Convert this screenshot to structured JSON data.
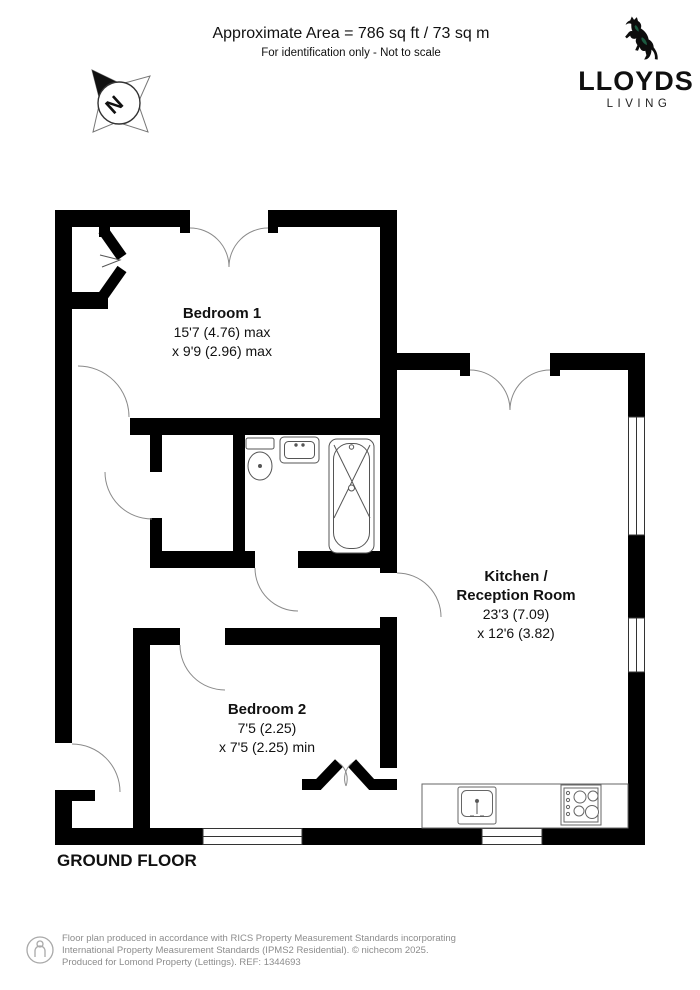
{
  "header": {
    "area": "Approximate Area = 786 sq ft / 73 sq m",
    "note": "For identification only - Not to scale"
  },
  "brand": {
    "name": "LLOYDS",
    "division": "LIVING",
    "horse_black": "#0d0d0d",
    "horse_green": "#1c5b41"
  },
  "compass": {
    "north_label": "N"
  },
  "floor": {
    "label": "GROUND FLOOR"
  },
  "rooms": {
    "bedroom1": {
      "name": "Bedroom 1",
      "dim1": "15'7 (4.76) max",
      "dim2": "x 9'9 (2.96) max"
    },
    "kitchen": {
      "name1": "Kitchen /",
      "name2": "Reception Room",
      "dim1": "23'3 (7.09)",
      "dim2": "x 12'6 (3.82)"
    },
    "bedroom2": {
      "name": "Bedroom 2",
      "dim1": "7'5 (2.25)",
      "dim2": "x 7'5 (2.25) min"
    }
  },
  "fixtures": [
    "toilet",
    "basin",
    "bath-with-shower",
    "kitchen-sink",
    "hob",
    "worktop"
  ],
  "colors": {
    "wall": "#000000",
    "door_arc": "#8a8a8a",
    "fixture": "#555555",
    "window": "#333333"
  },
  "footer": {
    "line1": "Floor plan produced in accordance with RICS Property Measurement Standards incorporating",
    "line2": "International Property Measurement Standards (IPMS2 Residential).   © nichecom 2025.",
    "line3": "Produced for Lomond Property (Lettings).   REF:  1344693"
  }
}
